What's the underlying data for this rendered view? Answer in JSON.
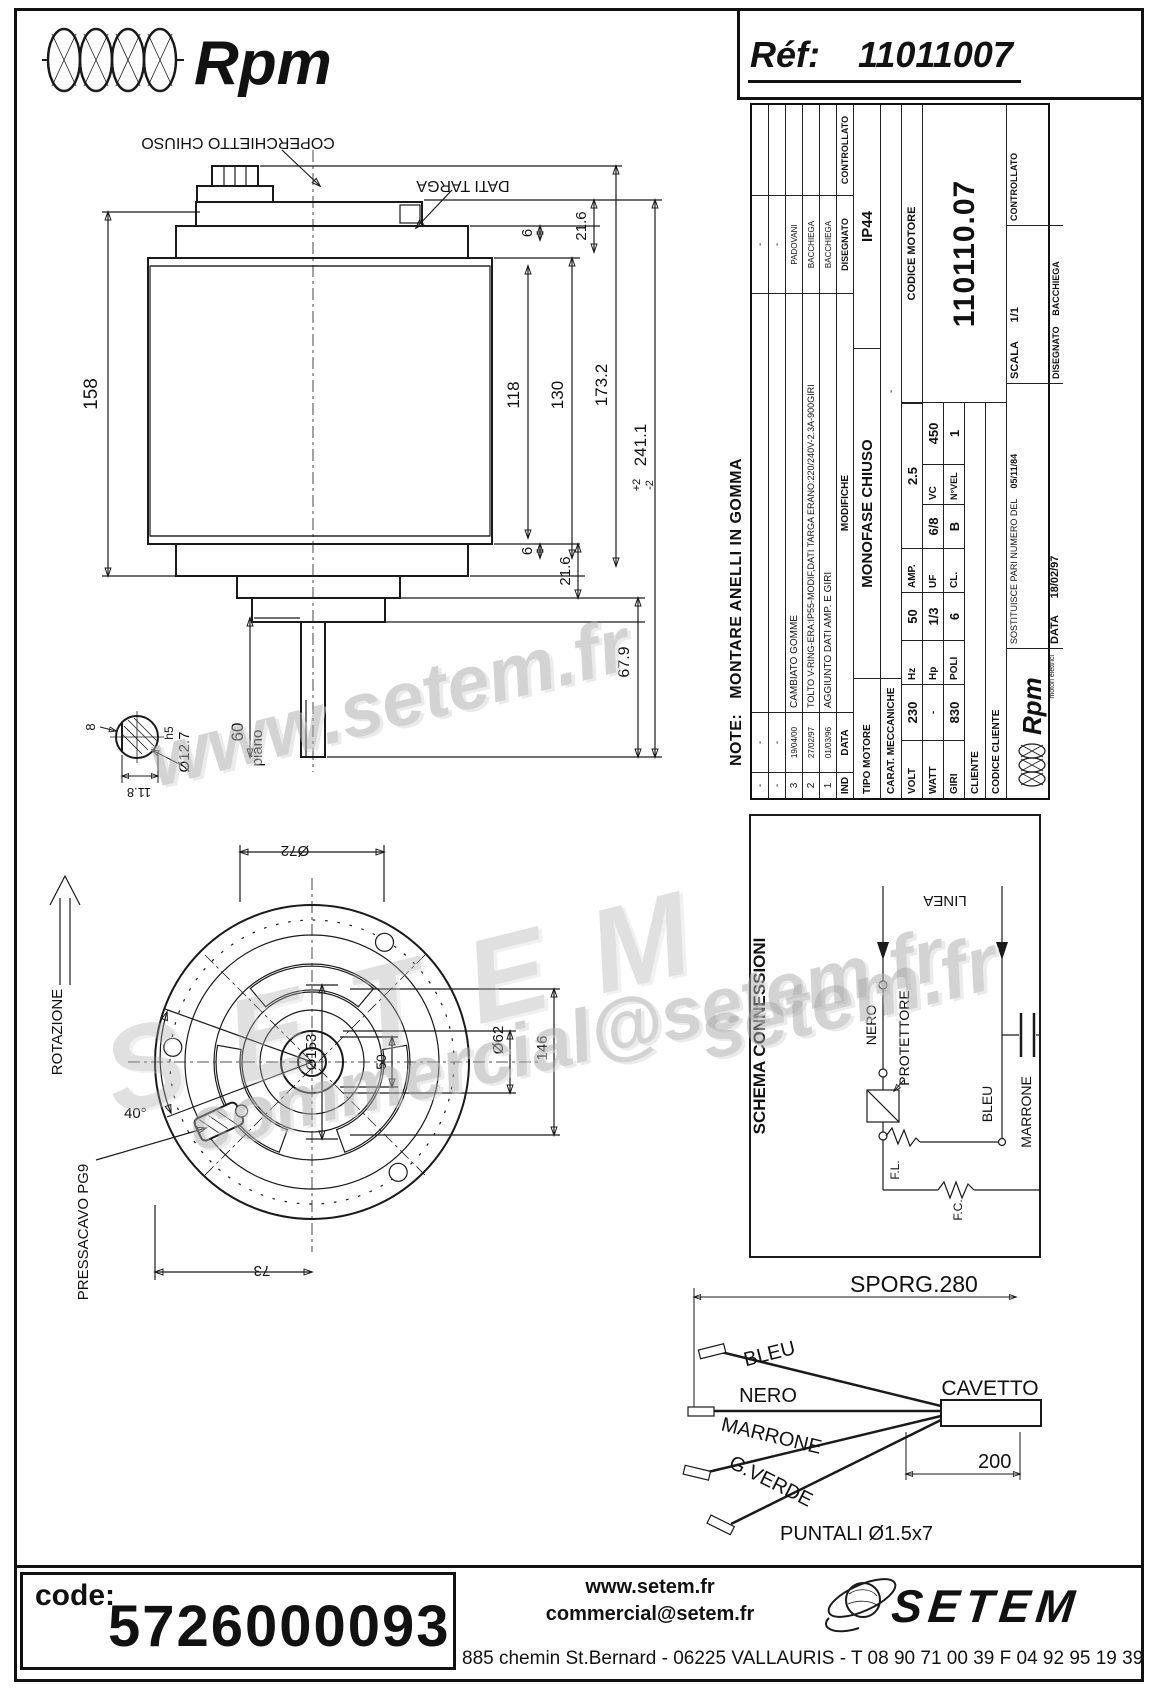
{
  "header": {
    "brand": "Rpm",
    "ref_label": "Réf:",
    "ref_value": "11011007"
  },
  "side_view": {
    "label_coperchietto": "COPERCHIETTO CHIUSO",
    "label_dati_targa": "DATI TARGA",
    "dims": {
      "body_len": "158",
      "d118": "118",
      "d130": "130",
      "d173": "173.2",
      "d21_top": "21.6",
      "d6_top": "6",
      "d21_bot": "21.6",
      "d6_bot": "6",
      "d241": "241.1",
      "d241_tol_plus": "+2",
      "d241_tol_minus": "-2",
      "d67": "67.9",
      "d60": "60",
      "piano": "piano",
      "shaft_dia": "Ø12.7",
      "shaft_fit": "h5",
      "d11_8": "11.8",
      "d8": "8"
    }
  },
  "front_view": {
    "dims": {
      "d72": "Ø72",
      "d153": "Ø153",
      "d50": "50",
      "d62": "Ø62",
      "d146": "146",
      "d73": "73",
      "d40": "40°"
    },
    "label_rotazione": "ROTAZIONE",
    "label_pressacavo": "PRESSACAVO PG9"
  },
  "note": {
    "prefix": "NOTE:",
    "text": "MONTARE ANELLI IN GOMMA"
  },
  "revisions": {
    "headers": {
      "ind": "IND",
      "data": "DATA",
      "modifiche": "MODIFICHE",
      "disegnato": "DISEGNATO",
      "controllato": "CONTROLLATO"
    },
    "rows": [
      {
        "ind": "-",
        "data": "-",
        "modifiche": "",
        "disegnato": "-",
        "controllato": ""
      },
      {
        "ind": "-",
        "data": "-",
        "modifiche": "",
        "disegnato": "-",
        "controllato": ""
      },
      {
        "ind": "3",
        "data": "19/04/00",
        "modifiche": "CAMBIATO GOMME",
        "disegnato": "PADOVANI",
        "controllato": ""
      },
      {
        "ind": "2",
        "data": "27/02/97",
        "modifiche": "TOLTO V-RING-ERA:IP55-MODIF,DATI TARGA ERANO:220/240V-2.3A-900GIRI",
        "disegnato": "BACCHIEGA",
        "controllato": ""
      },
      {
        "ind": "1",
        "data": "01/03/96",
        "modifiche": "AGGIUNTO DATI AMP. E GIRI",
        "disegnato": "BACCHIEGA",
        "controllato": ""
      }
    ]
  },
  "titleblock": {
    "tipo_motore_label": "TIPO MOTORE",
    "tipo_motore": "MONOFASE CHIUSO",
    "ip": "IP44",
    "carat_label": "CARAT. MECCANICHE",
    "carat_value": "-",
    "volt_label": "VOLT",
    "volt": "230",
    "hz_label": "Hz",
    "hz": "50",
    "amp_label": "AMP.",
    "amp": "2.5",
    "watt_label": "WATT",
    "watt": "-",
    "hp_label": "Hp",
    "hp": "1/3",
    "uf_label": "UF",
    "uf": "6/8",
    "vc_label": "VC",
    "vc": "450",
    "giri_label": "GIRI",
    "giri": "830",
    "poli_label": "POLI",
    "poli": "6",
    "cl_label": "CL.",
    "cl": "B",
    "nvel_label": "N°VEL",
    "nvel": "1",
    "cliente_label": "CLIENTE",
    "codice_cliente_label": "CODICE CLIENTE",
    "codice_motore_label": "CODICE MOTORE",
    "codice_motore": "110110.07",
    "logo": "Rpm",
    "logo_s": "motori elettrici",
    "sostituisce_label": "SOSTITUISCE PARI NUMERO DEL",
    "sostituisce_date": "05/11/84",
    "data_label": "DATA",
    "data_value": "18/02/97",
    "scala_label": "SCALA",
    "scala_value": "1/1",
    "disegnato_label": "DISEGNATO",
    "disegnato_value": "BACCHIEGA",
    "controllato_label": "CONTROLLATO"
  },
  "schematic": {
    "title": "SCHEMA CONNESSIONI",
    "linea": "LINEA",
    "nero": "NERO",
    "protettore": "PROTETTORE",
    "fl": "F.L.",
    "fc": "F.C.",
    "bleu": "BLEU",
    "marrone": "MARRONE"
  },
  "cable": {
    "sporg": "SPORG.280",
    "bleu": "BLEU",
    "nero": "NERO",
    "marrone": "MARRONE",
    "gverde": "G.VERDE",
    "cavetto": "CAVETTO",
    "len": "200",
    "puntali": "PUNTALI  Ø1.5x7"
  },
  "watermarks": {
    "w1": "www.setem.fr",
    "w2": "SETEM",
    "w3": "commercial@setem.fr",
    "w4": "setem.fr"
  },
  "footer": {
    "code_label": "code:",
    "code_value": "5726000093",
    "web": "www.setem.fr",
    "email": "commercial@setem.fr",
    "brand": "SETEM",
    "address": "885 chemin St.Bernard  -  06225 VALLAURIS  -  T 08 90 71 00 39   F 04 92 95 19 39"
  }
}
